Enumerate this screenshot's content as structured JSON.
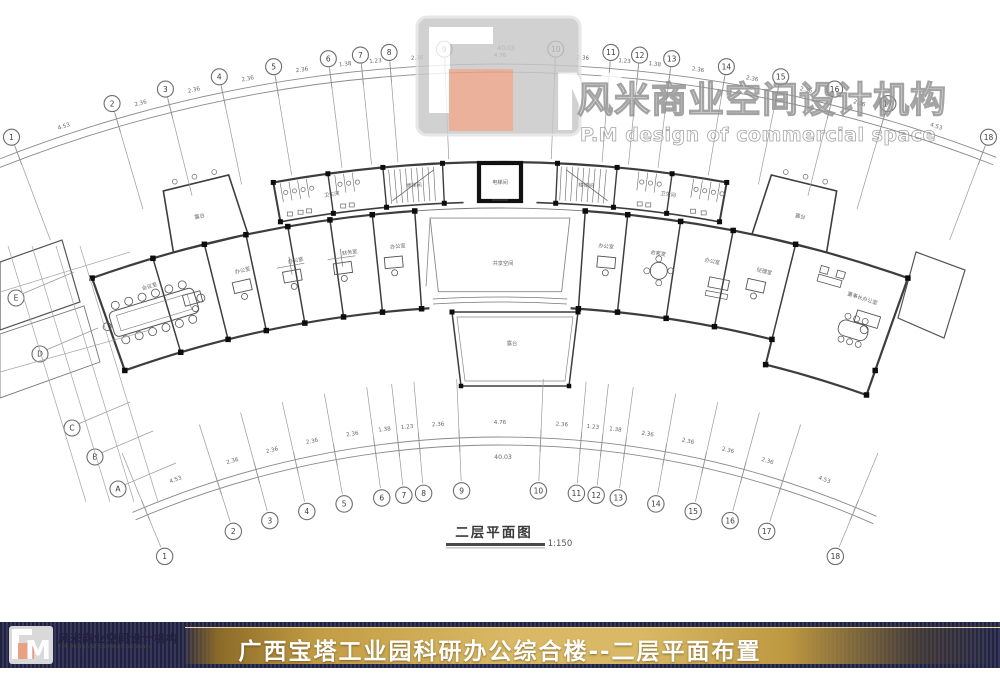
{
  "watermark": {
    "logo_m": "M",
    "company_cn": "风米商业空间设计机构",
    "company_en": "P.M design of commercial space"
  },
  "plan": {
    "caption": "二层平面图",
    "scale": "1:150",
    "total_dimension": "40.03",
    "grid_top": [
      "1",
      "2",
      "3",
      "4",
      "5",
      "6",
      "7",
      "8",
      "9",
      "10",
      "11",
      "12",
      "13",
      "14",
      "15",
      "16",
      "17",
      "18"
    ],
    "grid_bottom": [
      "1",
      "2",
      "3",
      "4",
      "5",
      "6",
      "7",
      "8",
      "9",
      "10",
      "11",
      "12",
      "13",
      "14",
      "15",
      "16",
      "17",
      "18"
    ],
    "grid_left": [
      "E",
      "D",
      "C",
      "B",
      "A"
    ],
    "dimensions": [
      "4.53",
      "2.36",
      "2.36",
      "2.36",
      "2.36",
      "1.38",
      "1.23",
      "2.36",
      "4.76",
      "2.36",
      "1.23",
      "1.38",
      "2.36",
      "2.36",
      "2.36",
      "2.36",
      "4.53"
    ],
    "rooms": [
      {
        "label": "卫生间",
        "x": 332,
        "y": 196,
        "r": -8
      },
      {
        "label": "楼梯间",
        "x": 414,
        "y": 187,
        "r": -4
      },
      {
        "label": "电梯间",
        "x": 500,
        "y": 184,
        "r": 0
      },
      {
        "label": "楼梯间",
        "x": 586,
        "y": 187,
        "r": 4
      },
      {
        "label": "卫生间",
        "x": 668,
        "y": 196,
        "r": 8
      },
      {
        "label": "露台",
        "x": 200,
        "y": 218,
        "r": -13
      },
      {
        "label": "露台",
        "x": 800,
        "y": 218,
        "r": 13
      },
      {
        "label": "会议室",
        "x": 150,
        "y": 288,
        "r": -17
      },
      {
        "label": "办公室",
        "x": 243,
        "y": 272,
        "r": -14
      },
      {
        "label": "办公室",
        "x": 296,
        "y": 262,
        "r": -11
      },
      {
        "label": "财务室",
        "x": 350,
        "y": 254,
        "r": -9
      },
      {
        "label": "办公室",
        "x": 398,
        "y": 248,
        "r": -6
      },
      {
        "label": "共享空间",
        "x": 503,
        "y": 265,
        "r": 0
      },
      {
        "label": "露台",
        "x": 512,
        "y": 345,
        "r": 0
      },
      {
        "label": "办公室",
        "x": 606,
        "y": 248,
        "r": 6
      },
      {
        "label": "会客室",
        "x": 658,
        "y": 255,
        "r": 9
      },
      {
        "label": "办公室",
        "x": 712,
        "y": 263,
        "r": 11
      },
      {
        "label": "经理室",
        "x": 764,
        "y": 273,
        "r": 14
      },
      {
        "label": "董事长办公室",
        "x": 862,
        "y": 300,
        "r": 18
      }
    ]
  },
  "footer": {
    "title": "广西宝塔工业园科研办公综合楼--二层平面布置",
    "company_cn": "风米商业空间设计机构",
    "company_en": "P.M design of commercial space"
  },
  "colors": {
    "accent_orange": "#e9a184",
    "bar_navy": "#2a2c48",
    "bar_gold": "#d9b965",
    "wall": "#3d3d3d"
  }
}
